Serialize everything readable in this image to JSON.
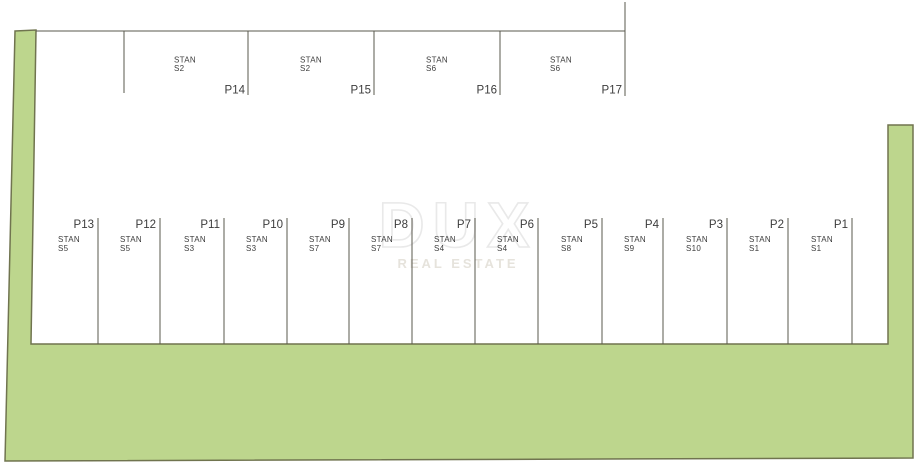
{
  "watermark": {
    "brand": "DUX",
    "tagline": "REAL ESTATE"
  },
  "colors": {
    "land_fill": "#bdd68d",
    "land_border": "#70744f",
    "plan_line": "#5a584e",
    "label_text": "#3c3c3c",
    "watermark": "#e9e9e9"
  },
  "top_row": {
    "stalls": [
      {
        "p": "P14",
        "stan": "STAN",
        "unit": "S2"
      },
      {
        "p": "P15",
        "stan": "STAN",
        "unit": "S2"
      },
      {
        "p": "P16",
        "stan": "STAN",
        "unit": "S6"
      },
      {
        "p": "P17",
        "stan": "STAN",
        "unit": "S6"
      }
    ]
  },
  "bottom_row": {
    "stalls": [
      {
        "p": "P13",
        "stan": "STAN",
        "unit": "S5"
      },
      {
        "p": "P12",
        "stan": "STAN",
        "unit": "S5"
      },
      {
        "p": "P11",
        "stan": "STAN",
        "unit": "S3"
      },
      {
        "p": "P10",
        "stan": "STAN",
        "unit": "S3"
      },
      {
        "p": "P9",
        "stan": "STAN",
        "unit": "S7"
      },
      {
        "p": "P8",
        "stan": "STAN",
        "unit": "S7"
      },
      {
        "p": "P7",
        "stan": "STAN",
        "unit": "S4"
      },
      {
        "p": "P6",
        "stan": "STAN",
        "unit": "S4"
      },
      {
        "p": "P5",
        "stan": "STAN",
        "unit": "S8"
      },
      {
        "p": "P4",
        "stan": "STAN",
        "unit": "S9"
      },
      {
        "p": "P3",
        "stan": "STAN",
        "unit": "S10"
      },
      {
        "p": "P2",
        "stan": "STAN",
        "unit": "S1"
      },
      {
        "p": "P1",
        "stan": "STAN",
        "unit": "S1"
      }
    ]
  }
}
